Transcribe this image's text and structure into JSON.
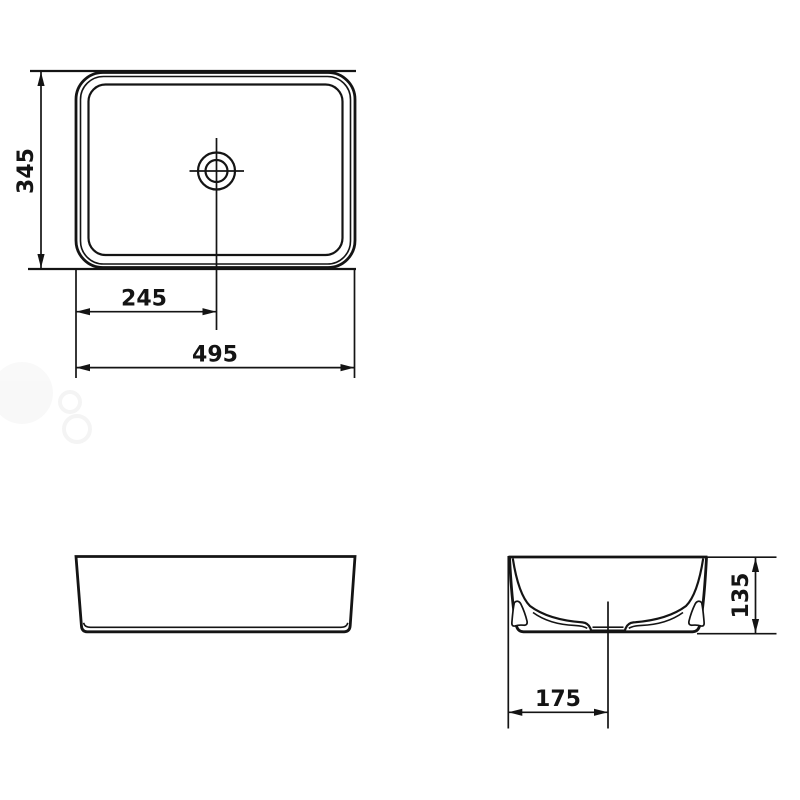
{
  "colors": {
    "line": "#141414",
    "background": "#ffffff",
    "watermark": "#f0f0f0"
  },
  "dimensions": {
    "top_view": {
      "height_mm": "345",
      "drain_offset_mm": "245",
      "width_mm": "495"
    },
    "side_view": {
      "height_mm": "135",
      "drain_offset_mm": "175"
    }
  }
}
